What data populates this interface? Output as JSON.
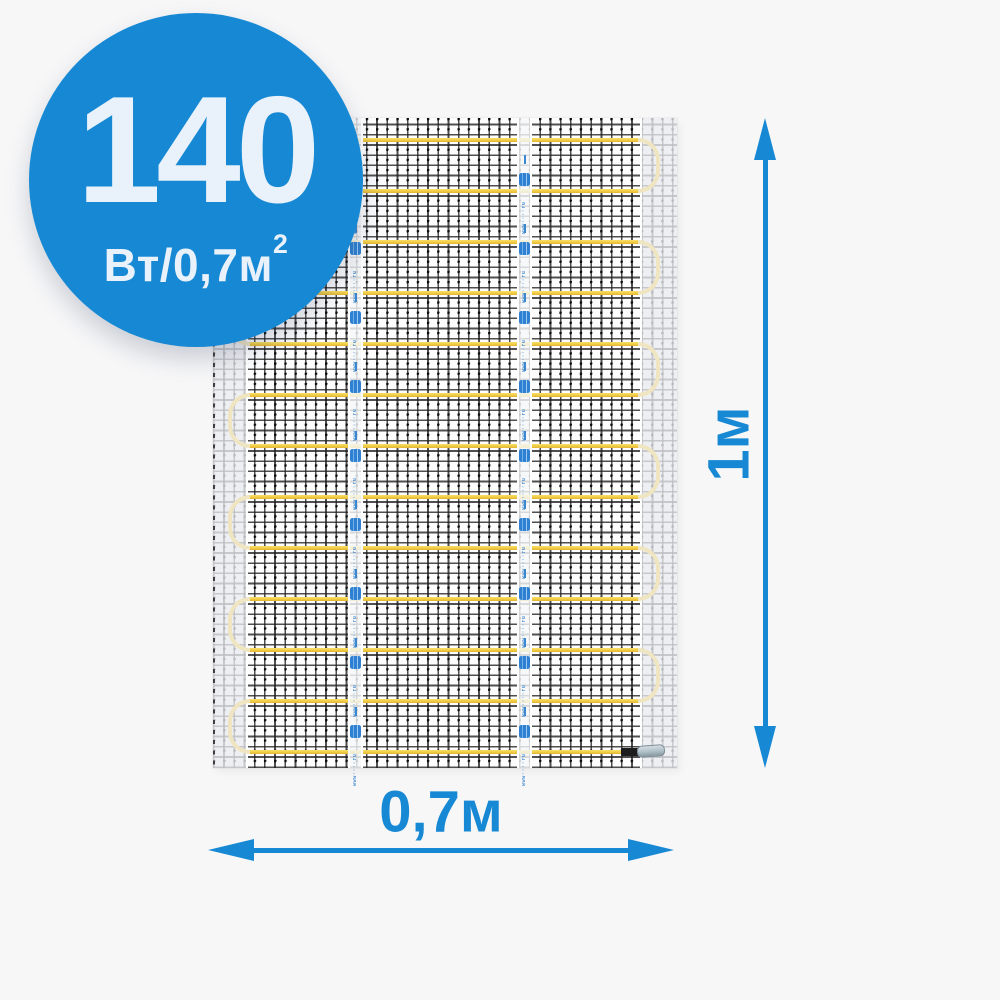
{
  "colors": {
    "background": "#f7f7f8",
    "accent": "#1789d4",
    "badge_text": "#e9f1fa",
    "cable": "#f0cc45",
    "cable_loop": "#f0e5c1",
    "mat_white": "#fdfdfe",
    "sleeve_silver": "#aebfc7"
  },
  "badge": {
    "power_value": "140",
    "power_unit": "Вт/0,7м",
    "power_unit_sup": "2"
  },
  "dimensions": {
    "height_label": "1м",
    "width_label": "0,7м"
  },
  "mat": {
    "tape_text": "www····ru",
    "layout": {
      "runs": 13,
      "spacing": 51,
      "firstRunY": 22,
      "meshLeft": 35,
      "meshRight": 427,
      "lastRunWidth": 375,
      "tapeX": [
        135,
        304
      ],
      "tapeWidth": 15,
      "tapeFirstMarkY": 55,
      "tapeMarkPeriod": 69,
      "tapeMarkCount": 9,
      "width": 464,
      "height": 650
    }
  }
}
